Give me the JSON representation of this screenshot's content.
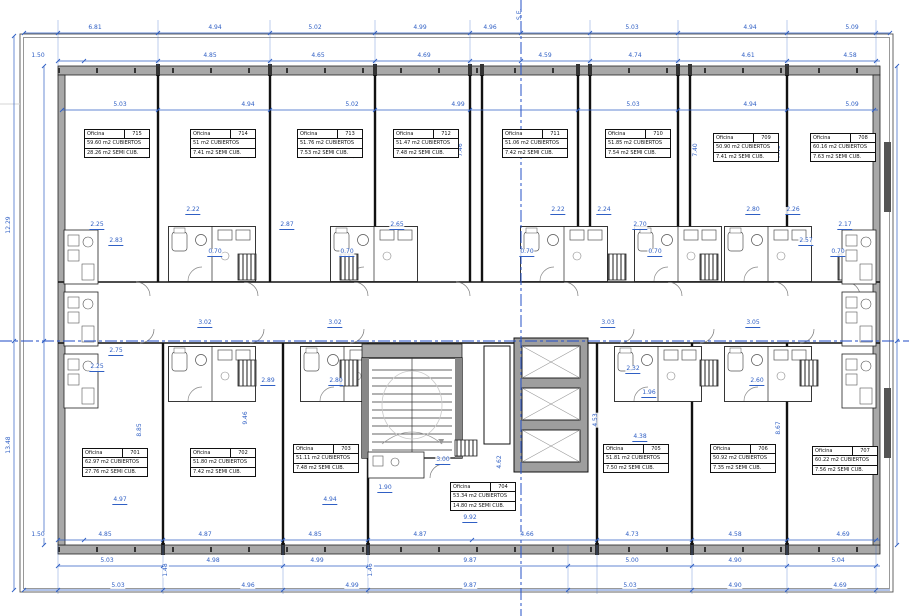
{
  "drawing": {
    "kind": "architectural floor plan - office level 7",
    "axis_label": "S.E.",
    "office_label_title": "Oficina"
  },
  "colors": {
    "dimension_blue": "#2f5fc4",
    "centerline_blue": "#2b55c8",
    "wall_gray": "#a8a8a8",
    "wall_dark": "#555555",
    "line_black": "#111111",
    "background": "#ffffff"
  },
  "offices": [
    {
      "label": "Oficina",
      "number": "715",
      "covered": "59.60 m2 CUBIERTOS",
      "semi": "28.26 m2 SEMI CUB.",
      "x": 84,
      "y": 129
    },
    {
      "label": "Oficina",
      "number": "714",
      "covered": "51 m2 CUBIERTOS",
      "semi": "7.41 m2 SEMI CUB.",
      "x": 190,
      "y": 129
    },
    {
      "label": "Oficina",
      "number": "713",
      "covered": "51.76 m2 CUBIERTOS",
      "semi": "7.53 m2 SEMI CUB.",
      "x": 297,
      "y": 129
    },
    {
      "label": "Oficina",
      "number": "712",
      "covered": "51.47 m2 CUBIERTOS",
      "semi": "7.48 m2 SEMI CUB.",
      "x": 393,
      "y": 129
    },
    {
      "label": "Oficina",
      "number": "711",
      "covered": "51.06 m2 CUBIERTOS",
      "semi": "7.42 m2 SEMI CUB.",
      "x": 502,
      "y": 129
    },
    {
      "label": "Oficina",
      "number": "710",
      "covered": "51.85 m2 CUBIERTOS",
      "semi": "7.54 m2 SEMI CUB.",
      "x": 605,
      "y": 129
    },
    {
      "label": "Oficina",
      "number": "709",
      "covered": "50.90 m2 CUBIERTOS",
      "semi": "7.41 m2 SEMI CUB.",
      "x": 713,
      "y": 133
    },
    {
      "label": "Oficina",
      "number": "708",
      "covered": "60.16 m2 CUBIERTOS",
      "semi": "7.63 m2 SEMI CUB.",
      "x": 810,
      "y": 133
    },
    {
      "label": "Oficina",
      "number": "701",
      "covered": "62.97 m2 CUBIERTOS",
      "semi": "27.76 m2 SEMI CUB.",
      "x": 82,
      "y": 448
    },
    {
      "label": "Oficina",
      "number": "702",
      "covered": "51.80 m2 CUBIERTOS",
      "semi": "7.42 m2 SEMI CUB.",
      "x": 190,
      "y": 448
    },
    {
      "label": "Oficina",
      "number": "703",
      "covered": "51.11 m2 CUBIERTOS",
      "semi": "7.48 m2 SEMI CUB.",
      "x": 293,
      "y": 444
    },
    {
      "label": "Oficina",
      "number": "704",
      "covered": "53.34 m2 CUBIERTOS",
      "semi": "14.80 m2 SEMI CUB.",
      "x": 450,
      "y": 482
    },
    {
      "label": "Oficina",
      "number": "705",
      "covered": "51.81 m2 CUBIERTOS",
      "semi": "7.50 m2 SEMI CUB.",
      "x": 603,
      "y": 444
    },
    {
      "label": "Oficina",
      "number": "706",
      "covered": "50.92 m2 CUBIERTOS",
      "semi": "7.35 m2 SEMI CUB.",
      "x": 710,
      "y": 444
    },
    {
      "label": "Oficina",
      "number": "707",
      "covered": "60.22 m2 CUBIERTOS",
      "semi": "7.56 m2 SEMI CUB.",
      "x": 812,
      "y": 446
    }
  ],
  "dim_labels": [
    {
      "t": "6.81",
      "x": 95,
      "y": 25,
      "o": "h"
    },
    {
      "t": "4.94",
      "x": 215,
      "y": 25,
      "o": "h"
    },
    {
      "t": "5.02",
      "x": 315,
      "y": 25,
      "o": "h"
    },
    {
      "t": "4.99",
      "x": 420,
      "y": 25,
      "o": "h"
    },
    {
      "t": "4.96",
      "x": 490,
      "y": 25,
      "o": "h"
    },
    {
      "t": "5.03",
      "x": 632,
      "y": 25,
      "o": "h"
    },
    {
      "t": "4.94",
      "x": 750,
      "y": 25,
      "o": "h"
    },
    {
      "t": "5.09",
      "x": 852,
      "y": 25,
      "o": "h"
    },
    {
      "t": "1.50",
      "x": 38,
      "y": 53,
      "o": "h"
    },
    {
      "t": "4.85",
      "x": 210,
      "y": 53,
      "o": "h"
    },
    {
      "t": "4.65",
      "x": 318,
      "y": 53,
      "o": "h"
    },
    {
      "t": "4.69",
      "x": 424,
      "y": 53,
      "o": "h"
    },
    {
      "t": "4.59",
      "x": 545,
      "y": 53,
      "o": "h"
    },
    {
      "t": "4.74",
      "x": 635,
      "y": 53,
      "o": "h"
    },
    {
      "t": "4.61",
      "x": 748,
      "y": 53,
      "o": "h"
    },
    {
      "t": "4.58",
      "x": 850,
      "y": 53,
      "o": "h"
    },
    {
      "t": "5.03",
      "x": 120,
      "y": 102,
      "o": "h"
    },
    {
      "t": "4.94",
      "x": 248,
      "y": 102,
      "o": "h"
    },
    {
      "t": "5.02",
      "x": 352,
      "y": 102,
      "o": "h"
    },
    {
      "t": "4.99",
      "x": 458,
      "y": 102,
      "o": "h"
    },
    {
      "t": "5.03",
      "x": 633,
      "y": 102,
      "o": "h"
    },
    {
      "t": "4.94",
      "x": 750,
      "y": 102,
      "o": "h"
    },
    {
      "t": "5.09",
      "x": 852,
      "y": 102,
      "o": "h"
    },
    {
      "t": "1.50",
      "x": 38,
      "y": 532,
      "o": "h"
    },
    {
      "t": "4.85",
      "x": 105,
      "y": 532,
      "o": "h"
    },
    {
      "t": "4.87",
      "x": 205,
      "y": 532,
      "o": "h"
    },
    {
      "t": "4.85",
      "x": 315,
      "y": 532,
      "o": "h"
    },
    {
      "t": "4.87",
      "x": 420,
      "y": 532,
      "o": "h"
    },
    {
      "t": "4.66",
      "x": 527,
      "y": 532,
      "o": "h"
    },
    {
      "t": "4.73",
      "x": 632,
      "y": 532,
      "o": "h"
    },
    {
      "t": "4.58",
      "x": 735,
      "y": 532,
      "o": "h"
    },
    {
      "t": "4.69",
      "x": 843,
      "y": 532,
      "o": "h"
    },
    {
      "t": "5.03",
      "x": 107,
      "y": 558,
      "o": "h"
    },
    {
      "t": "4.98",
      "x": 213,
      "y": 558,
      "o": "h"
    },
    {
      "t": "4.99",
      "x": 317,
      "y": 558,
      "o": "h"
    },
    {
      "t": "9.87",
      "x": 470,
      "y": 558,
      "o": "h"
    },
    {
      "t": "5.00",
      "x": 632,
      "y": 558,
      "o": "h"
    },
    {
      "t": "4.90",
      "x": 735,
      "y": 558,
      "o": "h"
    },
    {
      "t": "5.04",
      "x": 838,
      "y": 558,
      "o": "h"
    },
    {
      "t": "5.03",
      "x": 118,
      "y": 583,
      "o": "h"
    },
    {
      "t": "4.96",
      "x": 248,
      "y": 583,
      "o": "h"
    },
    {
      "t": "4.99",
      "x": 352,
      "y": 583,
      "o": "h"
    },
    {
      "t": "9.87",
      "x": 470,
      "y": 583,
      "o": "h"
    },
    {
      "t": "5.03",
      "x": 630,
      "y": 583,
      "o": "h"
    },
    {
      "t": "4.90",
      "x": 735,
      "y": 583,
      "o": "h"
    },
    {
      "t": "4.69",
      "x": 840,
      "y": 583,
      "o": "h"
    },
    {
      "t": "12.29",
      "x": 9,
      "y": 225,
      "o": "v"
    },
    {
      "t": "13.48",
      "x": 9,
      "y": 445,
      "o": "v"
    },
    {
      "t": "8.23",
      "x": 866,
      "y": 152,
      "o": "v"
    },
    {
      "t": "8.07",
      "x": 866,
      "y": 458,
      "o": "v"
    },
    {
      "t": "8.27",
      "x": 147,
      "y": 152,
      "o": "v"
    },
    {
      "t": "7.49",
      "x": 252,
      "y": 152,
      "o": "v"
    },
    {
      "t": "7.41",
      "x": 357,
      "y": 152,
      "o": "v"
    },
    {
      "t": "7.46",
      "x": 461,
      "y": 150,
      "o": "v"
    },
    {
      "t": "7.40",
      "x": 670,
      "y": 150,
      "o": "v"
    },
    {
      "t": "7.40",
      "x": 696,
      "y": 150,
      "o": "v"
    },
    {
      "t": "7.40",
      "x": 779,
      "y": 152,
      "o": "v"
    },
    {
      "t": "8.85",
      "x": 140,
      "y": 430,
      "o": "v"
    },
    {
      "t": "9.46",
      "x": 246,
      "y": 418,
      "o": "v"
    },
    {
      "t": "8.67",
      "x": 779,
      "y": 428,
      "o": "v"
    },
    {
      "t": "4.53",
      "x": 596,
      "y": 420,
      "o": "v"
    },
    {
      "t": "4.62",
      "x": 500,
      "y": 462,
      "o": "v"
    },
    {
      "t": "1.48",
      "x": 166,
      "y": 570,
      "o": "v"
    },
    {
      "t": "1.46",
      "x": 371,
      "y": 570,
      "o": "v"
    },
    {
      "t": "2.25",
      "x": 97,
      "y": 222,
      "o": "h",
      "u": true
    },
    {
      "t": "2.22",
      "x": 193,
      "y": 207,
      "o": "h",
      "u": true
    },
    {
      "t": "2.87",
      "x": 287,
      "y": 222,
      "o": "h",
      "u": true
    },
    {
      "t": "2.65",
      "x": 397,
      "y": 222,
      "o": "h",
      "u": true
    },
    {
      "t": "2.22",
      "x": 558,
      "y": 207,
      "o": "h",
      "u": true
    },
    {
      "t": "2.24",
      "x": 604,
      "y": 207,
      "o": "h",
      "u": true
    },
    {
      "t": "2.70",
      "x": 640,
      "y": 222,
      "o": "h",
      "u": true
    },
    {
      "t": "2.80",
      "x": 753,
      "y": 207,
      "o": "h",
      "u": true
    },
    {
      "t": "2.26",
      "x": 793,
      "y": 207,
      "o": "h",
      "u": true
    },
    {
      "t": "2.17",
      "x": 845,
      "y": 222,
      "o": "h",
      "u": true
    },
    {
      "t": "2.83",
      "x": 116,
      "y": 238,
      "o": "h",
      "u": true
    },
    {
      "t": "2.57",
      "x": 806,
      "y": 238,
      "o": "h",
      "u": true
    },
    {
      "t": "3.02",
      "x": 205,
      "y": 320,
      "o": "h",
      "u": true
    },
    {
      "t": "3.02",
      "x": 335,
      "y": 320,
      "o": "h",
      "u": true
    },
    {
      "t": "3.03",
      "x": 608,
      "y": 320,
      "o": "h",
      "u": true
    },
    {
      "t": "3.05",
      "x": 753,
      "y": 320,
      "o": "h",
      "u": true
    },
    {
      "t": "2.75",
      "x": 116,
      "y": 348,
      "o": "h",
      "u": true
    },
    {
      "t": "2.25",
      "x": 97,
      "y": 364,
      "o": "h",
      "u": true
    },
    {
      "t": "2.89",
      "x": 268,
      "y": 378,
      "o": "h",
      "u": true
    },
    {
      "t": "2.80",
      "x": 336,
      "y": 378,
      "o": "h",
      "u": true
    },
    {
      "t": "2.32",
      "x": 633,
      "y": 366,
      "o": "h",
      "u": true
    },
    {
      "t": "2.60",
      "x": 757,
      "y": 378,
      "o": "h",
      "u": true
    },
    {
      "t": "1.96",
      "x": 649,
      "y": 390,
      "o": "h",
      "u": true
    },
    {
      "t": "4.97",
      "x": 120,
      "y": 497,
      "o": "h",
      "u": true
    },
    {
      "t": "4.94",
      "x": 330,
      "y": 497,
      "o": "h",
      "u": true
    },
    {
      "t": "1.90",
      "x": 385,
      "y": 485,
      "o": "h",
      "u": true
    },
    {
      "t": "3.00",
      "x": 443,
      "y": 457,
      "o": "h",
      "u": true
    },
    {
      "t": "4.38",
      "x": 640,
      "y": 434,
      "o": "h",
      "u": true
    },
    {
      "t": "9.92",
      "x": 470,
      "y": 515,
      "o": "h",
      "u": true
    },
    {
      "t": "0.70",
      "x": 215,
      "y": 249,
      "o": "h",
      "u": true
    },
    {
      "t": "0.70",
      "x": 347,
      "y": 249,
      "o": "h",
      "u": true
    },
    {
      "t": "0.70",
      "x": 527,
      "y": 249,
      "o": "h",
      "u": true
    },
    {
      "t": "0.70",
      "x": 655,
      "y": 249,
      "o": "h",
      "u": true
    },
    {
      "t": "0.70",
      "x": 838,
      "y": 249,
      "o": "h",
      "u": true
    }
  ]
}
